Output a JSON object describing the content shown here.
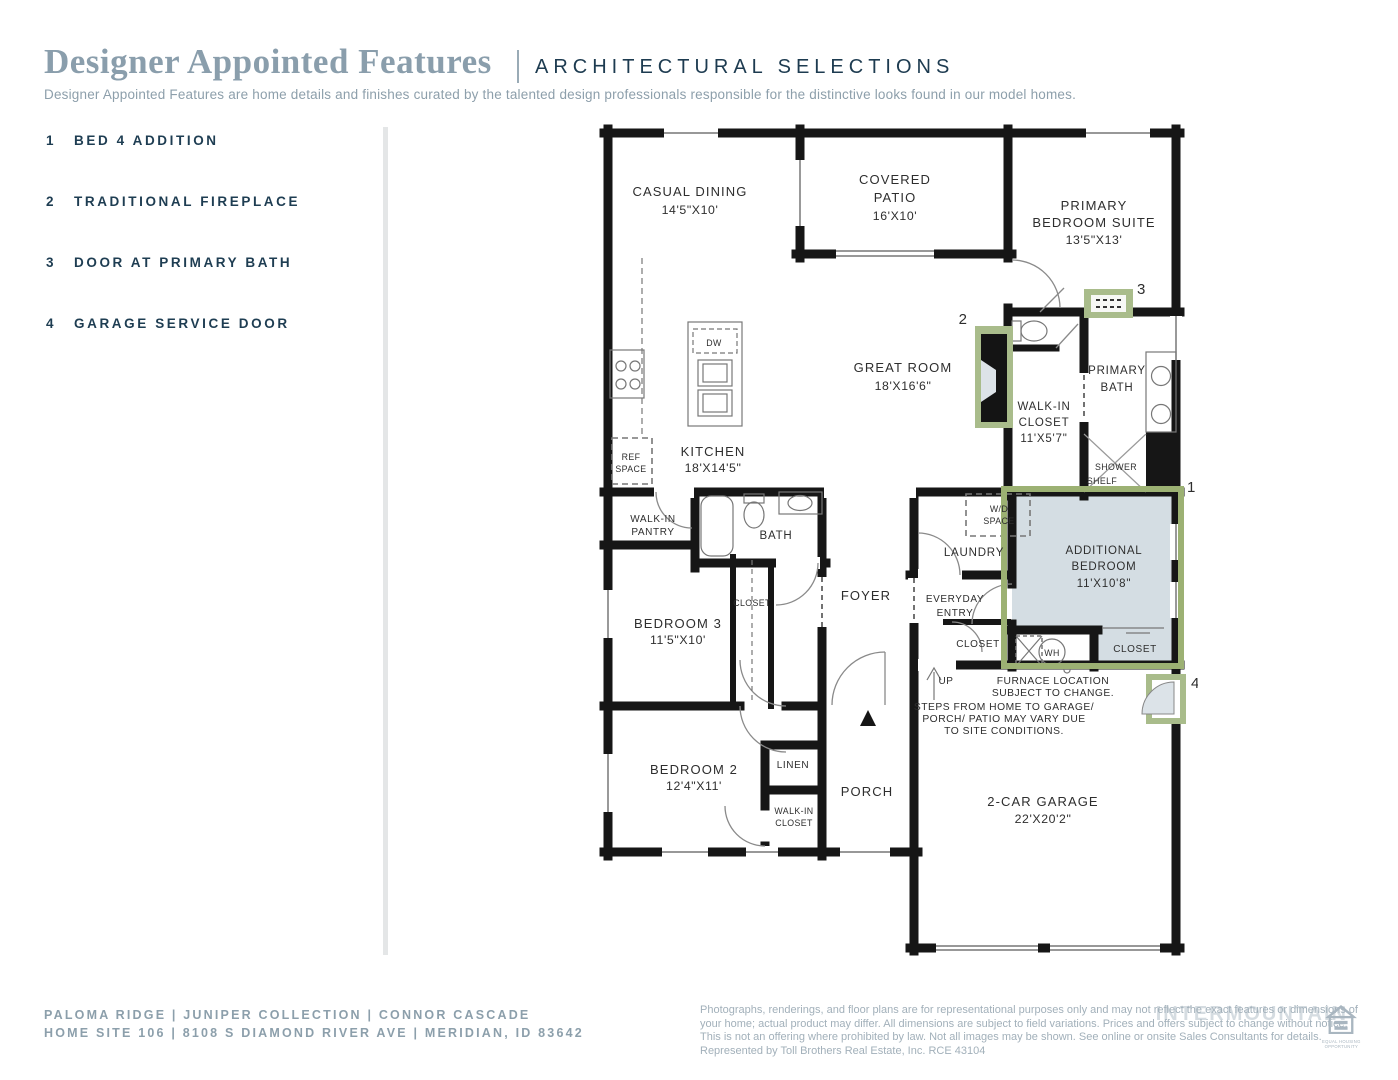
{
  "header": {
    "title": "Designer Appointed Features",
    "section": "ARCHITECTURAL SELECTIONS",
    "description": "Designer Appointed Features are home details and finishes curated by the talented design professionals responsible for the distinctive looks found in our model homes."
  },
  "features": [
    {
      "num": "1",
      "label": "BED 4 ADDITION"
    },
    {
      "num": "2",
      "label": "TRADITIONAL FIREPLACE"
    },
    {
      "num": "3",
      "label": "DOOR AT PRIMARY BATH"
    },
    {
      "num": "4",
      "label": "GARAGE SERVICE DOOR"
    }
  ],
  "plan": {
    "casual_dining": {
      "name": "CASUAL DINING",
      "dims": "14'5\"X10'"
    },
    "covered_patio": {
      "l1": "COVERED",
      "l2": "PATIO",
      "dims": "16'X10'"
    },
    "primary_suite": {
      "l1": "PRIMARY",
      "l2": "BEDROOM SUITE",
      "dims": "13'5\"X13'"
    },
    "great_room": {
      "name": "GREAT ROOM",
      "dims": "18'X16'6\""
    },
    "kitchen": {
      "name": "KITCHEN",
      "dims": "18'X14'5\""
    },
    "wic_primary": {
      "l1": "WALK-IN",
      "l2": "CLOSET",
      "dims": "11'X5'7\""
    },
    "primary_bath": {
      "l1": "PRIMARY",
      "l2": "BATH"
    },
    "shower": {
      "l1": "SHOWER",
      "l2": "SHELF"
    },
    "additional_bedroom": {
      "l1": "ADDITIONAL",
      "l2": "BEDROOM",
      "dims": "11'X10'8\""
    },
    "laundry": "LAUNDRY",
    "wd_space": {
      "l1": "W/D",
      "l2": "SPACE"
    },
    "everyday_entry": {
      "l1": "EVERYDAY",
      "l2": "ENTRY"
    },
    "closet_entry": "CLOSET",
    "closet_additional": "CLOSET",
    "water_heater": "WH",
    "up": "UP",
    "furnace_note": {
      "l1": "FURNACE LOCATION",
      "l2": "SUBJECT TO CHANGE."
    },
    "steps_note": {
      "l1": "STEPS FROM HOME TO GARAGE/",
      "l2": "PORCH/ PATIO MAY VARY DUE",
      "l3": "TO SITE CONDITIONS."
    },
    "garage": {
      "name": "2-CAR GARAGE",
      "dims": "22'X20'2\""
    },
    "pantry": {
      "l1": "WALK-IN",
      "l2": "PANTRY"
    },
    "bath": "BATH",
    "closet_bed3": "CLOSET",
    "bedroom3": {
      "name": "BEDROOM 3",
      "dims": "11'5\"X10'"
    },
    "foyer": "FOYER",
    "bedroom2": {
      "name": "BEDROOM 2",
      "dims": "12'4\"X11'"
    },
    "linen": "LINEN",
    "wic_bed2": {
      "l1": "WALK-IN",
      "l2": "CLOSET"
    },
    "porch": "PORCH",
    "ref_space": {
      "l1": "REF",
      "l2": "SPACE"
    },
    "dishwasher": "DW",
    "markers": {
      "m1": "1",
      "m2": "2",
      "m3": "3",
      "m4": "4"
    }
  },
  "footer": {
    "line1": "PALOMA RIDGE   |   JUNIPER COLLECTION   |   CONNOR CASCADE",
    "line2": "HOME SITE 106   |   8108 S DIAMOND RIVER AVE   |   MERIDIAN, ID 83642",
    "disclaimer": {
      "l1": "Photographs, renderings, and floor plans are for representational purposes only and may not reflect the exact features or dimensions of",
      "l2": "your home; actual product may differ. All dimensions are subject to field variations. Prices and offers subject to change without notice.",
      "l3": "This is not an offering where prohibited by law. Not all images may be shown. See online or onsite Sales Consultants for details.",
      "l4": "Represented by Toll Brothers Real Estate, Inc. RCE 43104"
    },
    "watermark": "INTERMOUNTAIN",
    "eho": {
      "l1": "EQUAL HOUSING",
      "l2": "OPPORTUNITY"
    }
  },
  "colors": {
    "accent_green": "#9cb173",
    "navy": "#1d3c52",
    "slate": "#8c9fab"
  }
}
